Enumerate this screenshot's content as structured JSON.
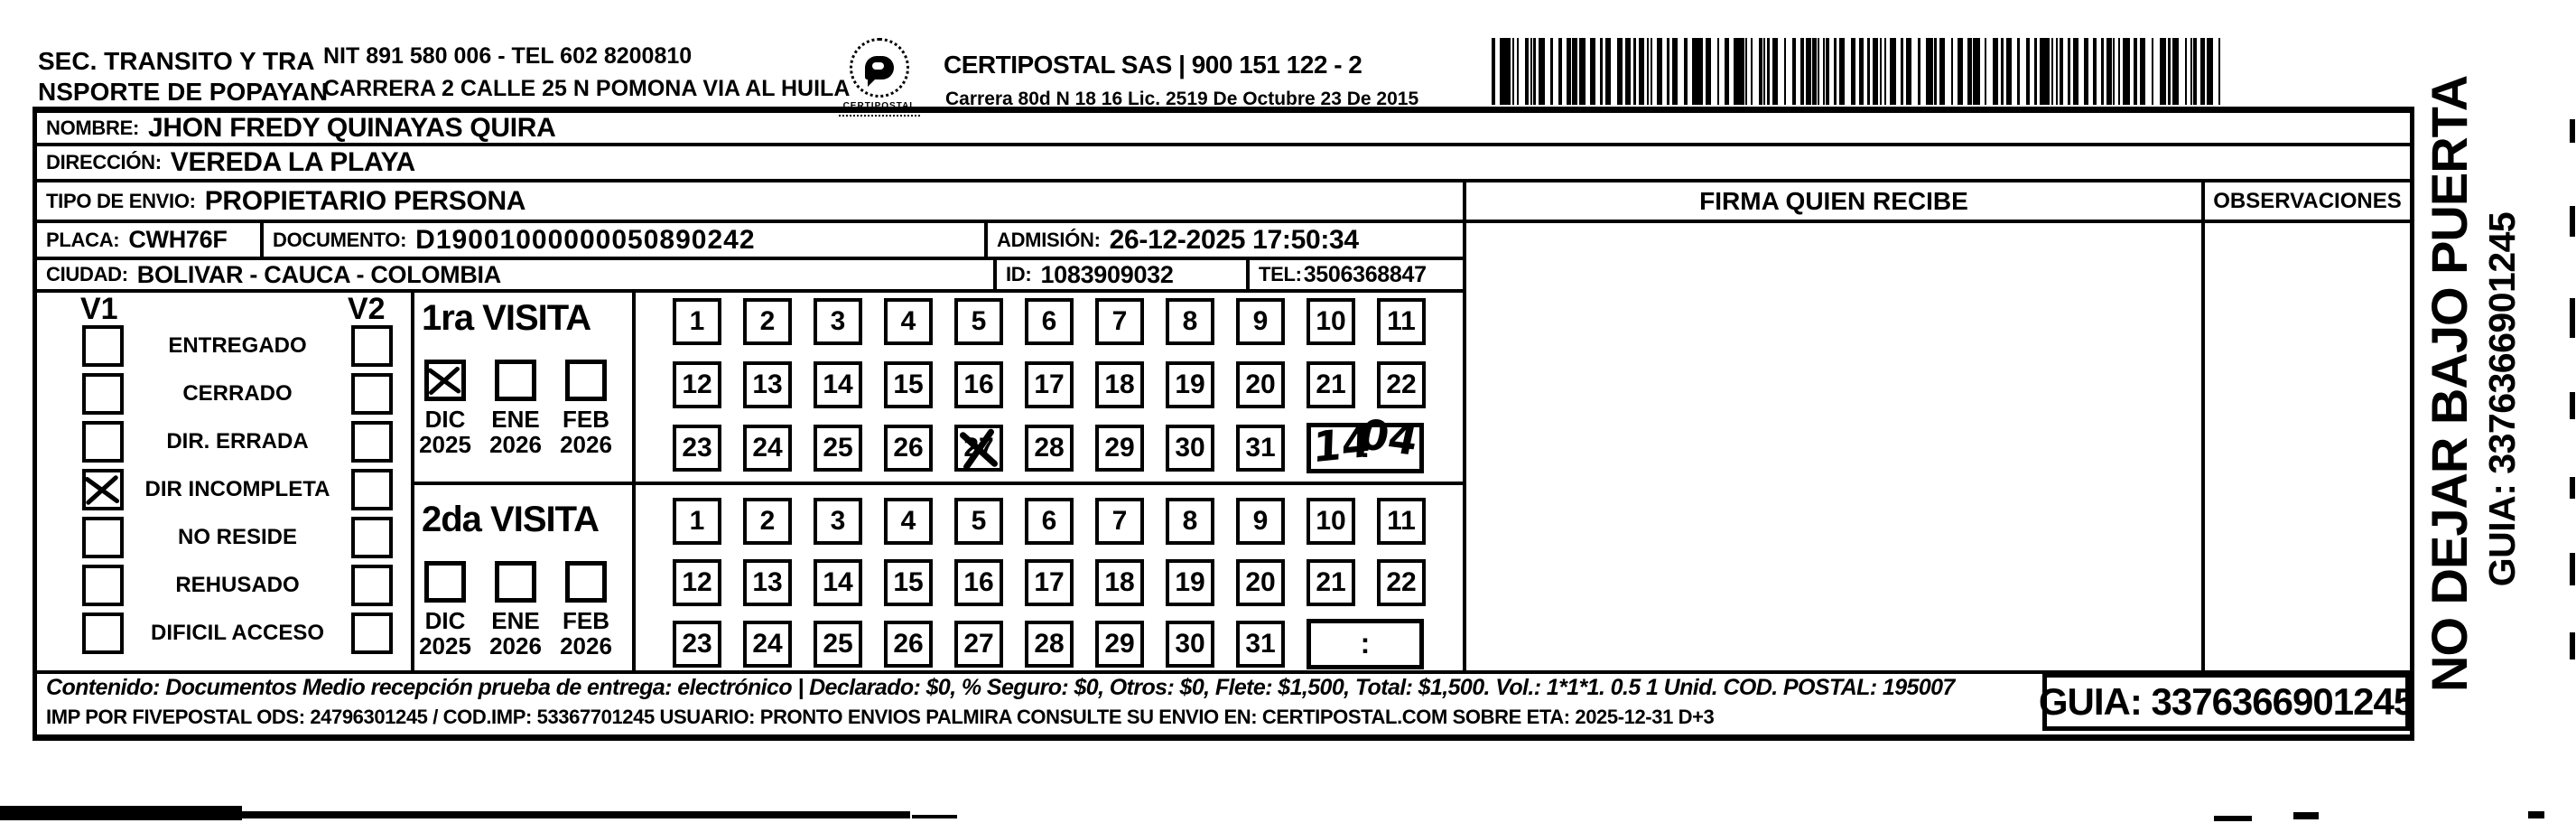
{
  "header": {
    "sender_line1": "SEC. TRANSITO Y TRA",
    "sender_line2": "NSPORTE DE POPAYAN",
    "sender_nit_tel": "NIT 891 580 006 - TEL 602 8200810",
    "sender_address": "CARRERA 2 CALLE 25 N POMONA VIA AL HUILA",
    "logo_caption": "CERTIPOSTAL",
    "company_line": "CERTIPOSTAL SAS | 900 151 122 - 2",
    "company_address": "Carrera 80d N 18 16  Lic. 2519 De Octubre 23 De 2015"
  },
  "fields": {
    "nombre": {
      "label": "NOMBRE:",
      "value": "JHON FREDY QUINAYAS QUIRA"
    },
    "direccion": {
      "label": "DIRECCIÓN:",
      "value": "VEREDA LA PLAYA"
    },
    "tipo_envio": {
      "label": "TIPO DE ENVIO:",
      "value": "PROPIETARIO PERSONA"
    },
    "placa": {
      "label": "PLACA:",
      "value": "CWH76F"
    },
    "documento": {
      "label": "DOCUMENTO:",
      "value": "D19001000000050890242"
    },
    "admision": {
      "label": "ADMISIÓN:",
      "value": "26-12-2025 17:50:34"
    },
    "ciudad": {
      "label": "CIUDAD:",
      "value": "BOLIVAR - CAUCA - COLOMBIA"
    },
    "id": {
      "label": "ID:",
      "value": "1083909032"
    },
    "tel": {
      "label": "TEL:",
      "value": "3506368847"
    }
  },
  "status_panel": {
    "v1_label": "V1",
    "v2_label": "V2",
    "rows": [
      {
        "label": "ENTREGADO",
        "v1_checked": false,
        "v2_checked": false
      },
      {
        "label": "CERRADO",
        "v1_checked": false,
        "v2_checked": false
      },
      {
        "label": "DIR. ERRADA",
        "v1_checked": false,
        "v2_checked": false
      },
      {
        "label": "DIR INCOMPLETA",
        "v1_checked": true,
        "v2_checked": false
      },
      {
        "label": "NO RESIDE",
        "v1_checked": false,
        "v2_checked": false
      },
      {
        "label": "REHUSADO",
        "v1_checked": false,
        "v2_checked": false
      },
      {
        "label": "DIFICIL ACCESO",
        "v1_checked": false,
        "v2_checked": false
      }
    ]
  },
  "visits": [
    {
      "title": "1ra VISITA",
      "months": [
        {
          "label": "DIC",
          "year": "2025",
          "checked": true
        },
        {
          "label": "ENE",
          "year": "2026",
          "checked": false
        },
        {
          "label": "FEB",
          "year": "2026",
          "checked": false
        }
      ],
      "day_start": 1,
      "day_end": 31,
      "crossed_day": 27,
      "time": {
        "handwritten_left": "14",
        "separator": ":",
        "handwritten_right": "04"
      }
    },
    {
      "title": "2da VISITA",
      "months": [
        {
          "label": "DIC",
          "year": "2025",
          "checked": false
        },
        {
          "label": "ENE",
          "year": "2026",
          "checked": false
        },
        {
          "label": "FEB",
          "year": "2026",
          "checked": false
        }
      ],
      "day_start": 1,
      "day_end": 31,
      "crossed_day": null,
      "time": {
        "handwritten_left": "",
        "separator": ":",
        "handwritten_right": ""
      }
    }
  ],
  "right_panel": {
    "firma_header": "FIRMA QUIEN RECIBE",
    "observaciones_header": "OBSERVACIONES"
  },
  "side_strip": {
    "line1": "NO DEJAR BAJO PUERTA",
    "line2": "GUIA: 3376366901245"
  },
  "footer": {
    "contenido_line": "Contenido: Documentos Medio recepción prueba de entrega: electrónico | Declarado: $0, % Seguro: $0, Otros: $0, Flete: $1,500, Total: $1,500. Vol.: 1*1*1. 0.5 1 Unid. COD. POSTAL: 195007",
    "imp_line": "IMP POR FIVEPOSTAL ODS: 24796301245 / COD.IMP: 53367701245 USUARIO: PRONTO ENVIOS PALMIRA CONSULTE SU ENVIO EN: CERTIPOSTAL.COM SOBRE ETA: 2025-12-31 D+3",
    "guia_box": "GUIA: 3376366901245"
  },
  "icons": {
    "barcode": "code128-tracking-barcode",
    "logo": "certipostal-logo"
  }
}
